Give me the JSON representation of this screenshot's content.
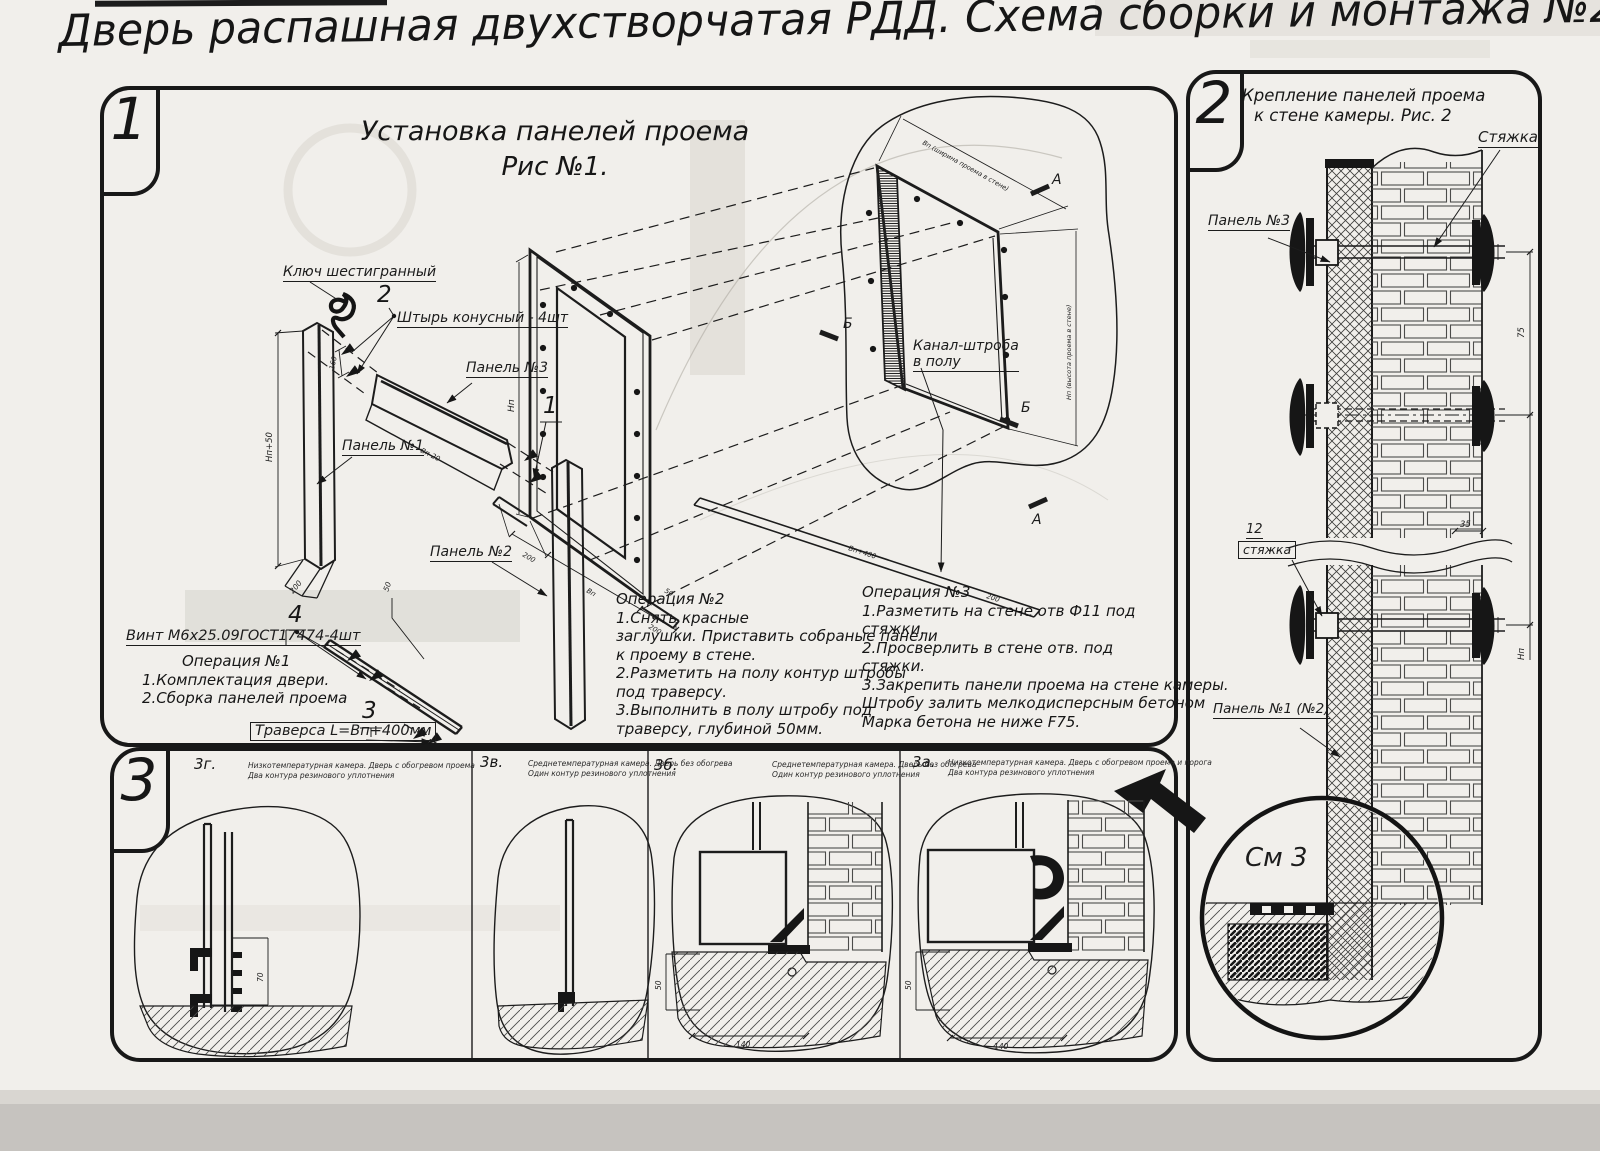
{
  "page": {
    "title": "Дверь распашная двухстворчатая РДД.  Схема сборки и монтажа №2"
  },
  "s1": {
    "num": "1",
    "title1": "Установка панелей проема",
    "title2": "Рис №1.",
    "lbl_key": "Ключ шестигранный",
    "lbl_pin": "Штырь конусный - 4шт",
    "lbl_p3": "Панель №3",
    "lbl_p1": "Панель №1",
    "lbl_p2": "Панель №2",
    "lbl_screw": "Винт М6х25.09ГОСТ17474-4шт",
    "lbl_traverse": "Траверса  L=Вп+400мм",
    "lbl_channel1": "Канал-штроба",
    "lbl_channel2": "в полу",
    "c1": "1",
    "c2": "2",
    "c3": "3",
    "c4": "4",
    "mark_a": "А",
    "mark_b": "Б",
    "dim_np50": "Нп+50",
    "dim_200": "200",
    "dim_160": "160",
    "dim_vp20": "Вп-20",
    "dim_50": "50",
    "dim_np": "Нп",
    "dim_vp": "Вп",
    "dim_vp400": "Вп+400",
    "dim_w": "Вп (ширина проема в стене)",
    "dim_h": "Нп (высота проема в стене)",
    "op1_title": "Операция №1",
    "op1_l1": "1.Комплектация двери.",
    "op1_l2": "2.Сборка панелей проема",
    "op2_title": "Операция №2",
    "op2_l1": "1.Снять красные",
    "op2_l2": "заглушки. Приставить собраные панели",
    "op2_l3": "к проему в стене.",
    "op2_l4": "2.Разметить на полу контур штробы",
    "op2_l5": "под траверсу.",
    "op2_l6": "3.Выполнить в полу штробу под",
    "op2_l7": "траверсу, глубиной 50мм.",
    "op3_title": "Операция №3",
    "op3_l1": "1.Разметить на стене отв Ф11 под",
    "op3_l2": "стяжки.",
    "op3_l3": "2.Просверлить в стене отв.  под",
    "op3_l4": "стяжки.",
    "op3_l5": "3.Закрепить панели проема на стене камеры.",
    "op3_l6": "Штробу залить мелкодисперсным бетоном",
    "op3_l7": "Марка бетона не ниже  F75."
  },
  "s2": {
    "num": "2",
    "title1": "Крепление панелей проема",
    "title2": "к стене камеры. Рис. 2",
    "lbl_tie": "Стяжка",
    "lbl_p3": "Панель №3",
    "lbl_12": "12",
    "lbl_tie2": "стяжка",
    "lbl_p12": "Панель №1 (№2)",
    "lbl_see3": "См 3",
    "dim_35": "35",
    "dim_75": "75",
    "dim_np": "Нп"
  },
  "s3": {
    "num": "3",
    "d1_id": "3г.",
    "d1_c1": "Низкотемпературная камера. Дверь с обогревом проема",
    "d1_c2": "Два контура резинового уплотнения",
    "d2_id": "3в.",
    "d2_c1": "Среднетемпературная камера. Дверь без обогрева",
    "d2_c2": "Один контур резинового уплотнения",
    "d3_id": "3б.",
    "d3_c1": "Среднетемпературная камера. Дверь без обогрева",
    "d3_c2": "Один контур резинового уплотнения",
    "d4_id": "3а.",
    "d4_c1": "Низкотемпературная камера. Дверь с обогревом проема и порога",
    "d4_c2": "Два контура резинового уплотнения",
    "dim_70": "70",
    "dim_50": "50",
    "dim_140": "140"
  }
}
